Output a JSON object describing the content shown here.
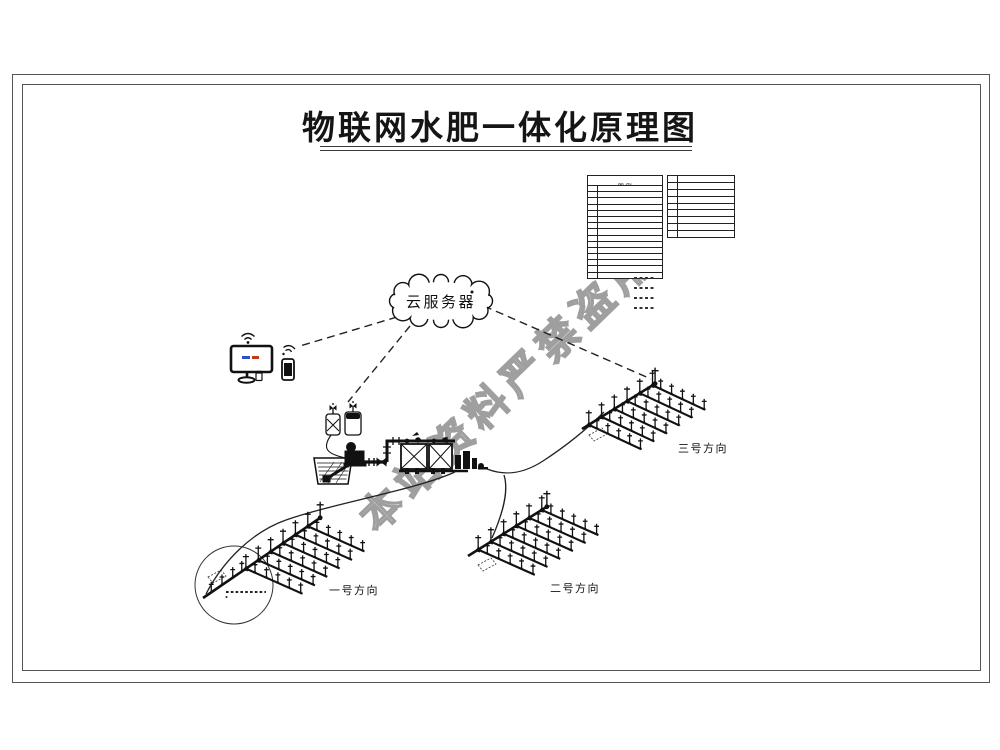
{
  "title": "物联网水肥一体化原理图",
  "watermark": "本站资料严禁盗用",
  "cloud": {
    "label": "云服务器"
  },
  "fields": [
    {
      "label": "一号方向"
    },
    {
      "label": "二号方向"
    },
    {
      "label": "三号方向"
    }
  ],
  "legend": {
    "title": "图例",
    "left_rows": [
      {
        "no": "1",
        "desc": "潜水泵"
      },
      {
        "no": "2",
        "desc": "止回阀"
      },
      {
        "no": "3",
        "desc": "闸阀"
      },
      {
        "no": "4",
        "desc": "水表"
      },
      {
        "no": "5",
        "desc": "过滤器"
      },
      {
        "no": "6",
        "desc": "施肥机"
      },
      {
        "no": "7",
        "desc": "压力表"
      },
      {
        "no": "8",
        "desc": "电磁阀"
      },
      {
        "no": "9",
        "desc": "田间控制器"
      },
      {
        "no": "10",
        "desc": "球阀"
      },
      {
        "no": "11",
        "desc": "主管道"
      },
      {
        "no": "12",
        "desc": "支管道"
      },
      {
        "no": "13",
        "desc": "毛管"
      },
      {
        "no": "14",
        "desc": "滴头"
      },
      {
        "no": "15",
        "desc": "喷头"
      }
    ],
    "right_rows": [
      {
        "no": "16",
        "desc": "云服务器"
      },
      {
        "no": "17",
        "desc": "监控电脑"
      },
      {
        "no": "18",
        "desc": "手机终端"
      },
      {
        "no": "19",
        "desc": "蓄水池"
      },
      {
        "no": "20",
        "desc": "水泵机组"
      },
      {
        "no": "21",
        "desc": "控制柜"
      },
      {
        "no": "22",
        "desc": "流量计"
      },
      {
        "no": "23",
        "desc": "变频器"
      },
      {
        "no": "24",
        "desc": "传感器"
      }
    ]
  },
  "colors": {
    "line": "#1a1a1a",
    "watermark_stroke": "#9f9f9f",
    "screen_blue": "#2b4fd0",
    "screen_red": "#c03a1e"
  }
}
